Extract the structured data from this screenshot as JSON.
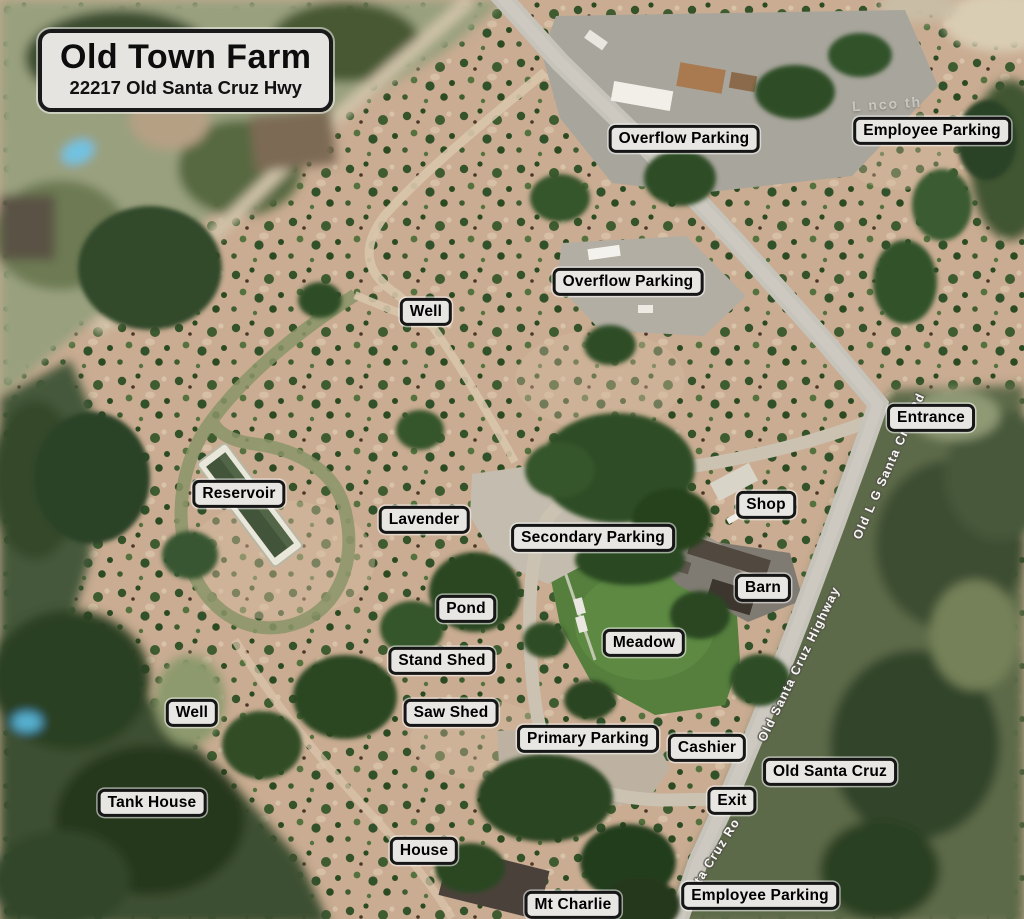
{
  "map": {
    "title_box": {
      "title": "Old Town Farm",
      "subtitle": "22217 Old Santa Cruz Hwy"
    },
    "labels": [
      {
        "id": "overflow-parking-north",
        "text": "Overflow Parking",
        "x": 684,
        "y": 139
      },
      {
        "id": "employee-parking-north",
        "text": "Employee Parking",
        "x": 932,
        "y": 131
      },
      {
        "id": "overflow-parking-central",
        "text": "Overflow Parking",
        "x": 628,
        "y": 282
      },
      {
        "id": "well-north",
        "text": "Well",
        "x": 426,
        "y": 312
      },
      {
        "id": "entrance",
        "text": "Entrance",
        "x": 931,
        "y": 418
      },
      {
        "id": "reservoir",
        "text": "Reservoir",
        "x": 239,
        "y": 494
      },
      {
        "id": "lavender",
        "text": "Lavender",
        "x": 424,
        "y": 520
      },
      {
        "id": "secondary-parking",
        "text": "Secondary Parking",
        "x": 593,
        "y": 538
      },
      {
        "id": "shop",
        "text": "Shop",
        "x": 766,
        "y": 505
      },
      {
        "id": "barn",
        "text": "Barn",
        "x": 763,
        "y": 588
      },
      {
        "id": "pond",
        "text": "Pond",
        "x": 466,
        "y": 609
      },
      {
        "id": "meadow",
        "text": "Meadow",
        "x": 644,
        "y": 643
      },
      {
        "id": "stand-shed",
        "text": "Stand Shed",
        "x": 442,
        "y": 661
      },
      {
        "id": "saw-shed",
        "text": "Saw Shed",
        "x": 451,
        "y": 713
      },
      {
        "id": "well-west",
        "text": "Well",
        "x": 192,
        "y": 713
      },
      {
        "id": "primary-parking",
        "text": "Primary Parking",
        "x": 588,
        "y": 739
      },
      {
        "id": "cashier",
        "text": "Cashier",
        "x": 707,
        "y": 748
      },
      {
        "id": "old-santa-cruz",
        "text": "Old Santa Cruz",
        "x": 830,
        "y": 772
      },
      {
        "id": "tank-house",
        "text": "Tank House",
        "x": 152,
        "y": 803
      },
      {
        "id": "exit",
        "text": "Exit",
        "x": 732,
        "y": 801
      },
      {
        "id": "house",
        "text": "House",
        "x": 424,
        "y": 851
      },
      {
        "id": "mt-charlie",
        "text": "Mt Charlie",
        "x": 573,
        "y": 905
      },
      {
        "id": "employee-parking-south",
        "text": "Employee Parking",
        "x": 760,
        "y": 896
      }
    ],
    "road_labels": [
      {
        "id": "old-lg-santa-cruz-rd",
        "text": "Old L G Santa Cruz Rd",
        "x": 889,
        "y": 466,
        "angle": -66
      },
      {
        "id": "old-santa-cruz-highway",
        "text": "Old Santa Cruz Highway",
        "x": 799,
        "y": 664,
        "angle": -64
      },
      {
        "id": "santa-cruz-rd-partial",
        "text": "ta Cruz Ro",
        "x": 717,
        "y": 851,
        "angle": -58
      }
    ],
    "faint_text": {
      "text": "L nco th"
    },
    "colors": {
      "label_bg": "#e7e6e3",
      "label_border": "#161616",
      "label_text": "#000000",
      "road_label_text": "#ffffff",
      "terrain_tan": "#c9ac92",
      "forest_green": "#2c4724",
      "meadow_green": "#567f3e",
      "road_gray": "#c6c3bb",
      "pool_blue": "#6cc0e0"
    }
  }
}
